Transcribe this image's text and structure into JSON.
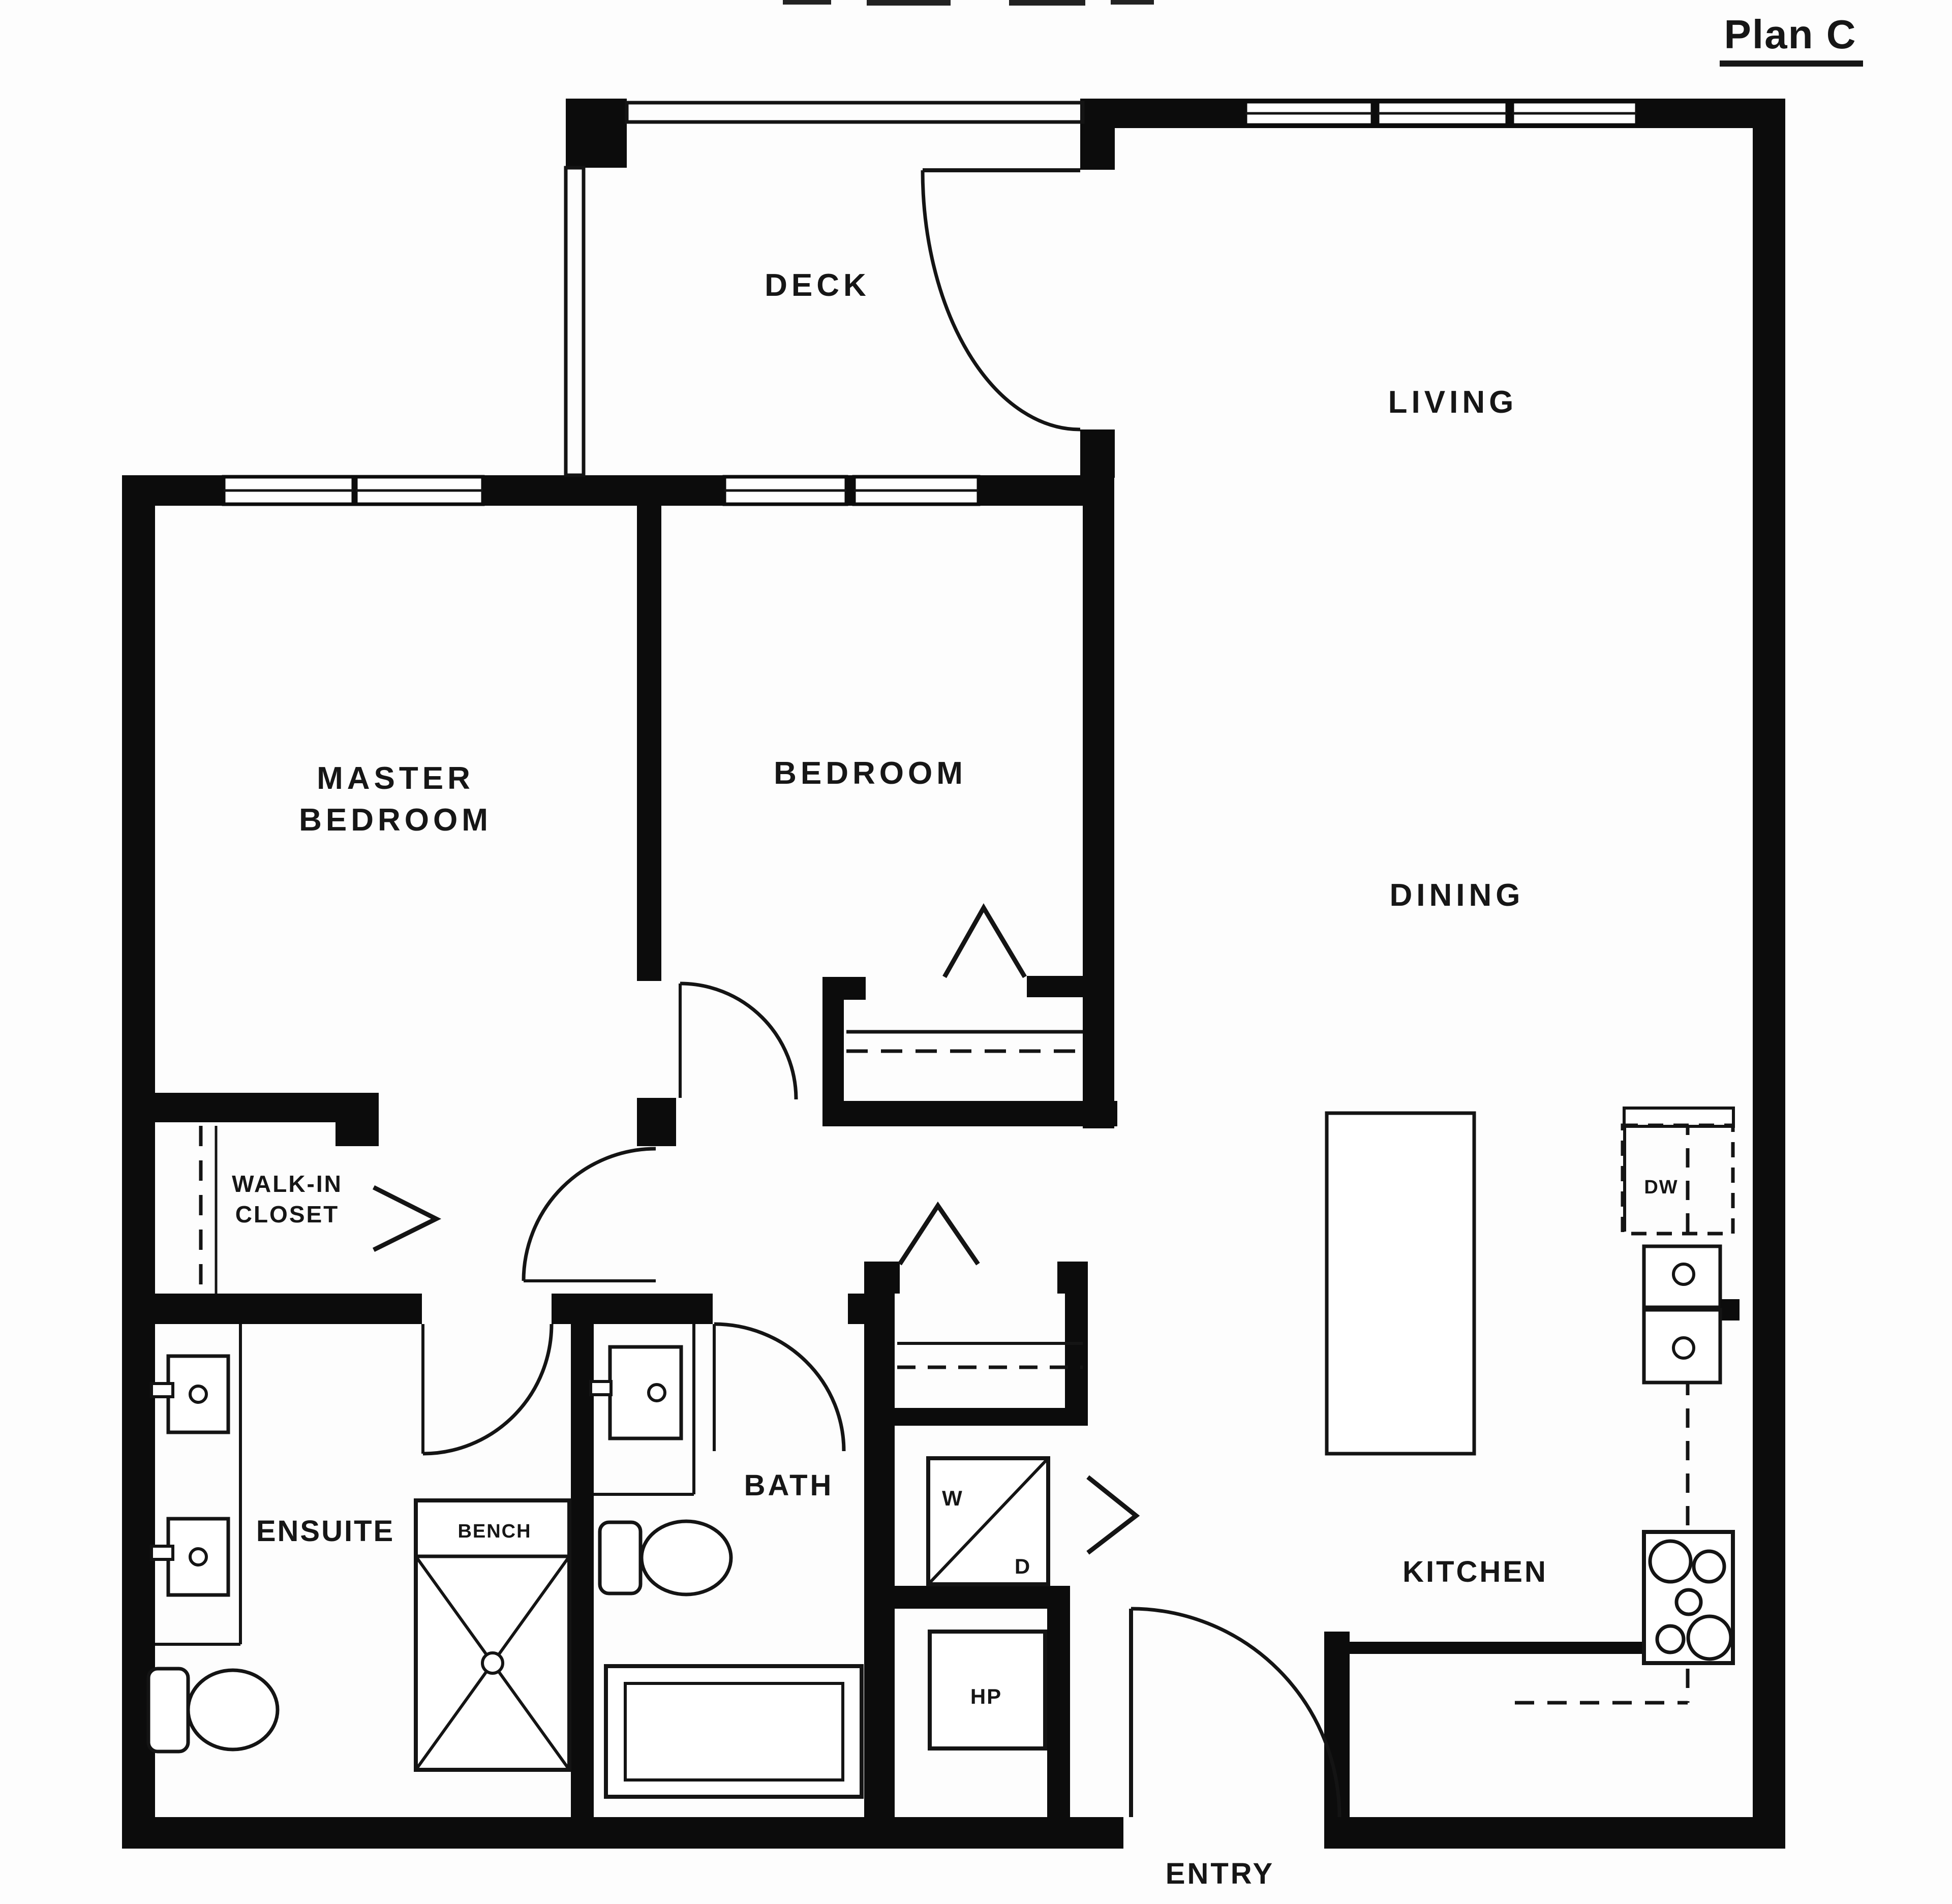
{
  "title": {
    "text": "Plan C"
  },
  "rooms": {
    "deck": "DECK",
    "living": "LIVING",
    "dining": "DINING",
    "master_bedroom_line1": "MASTER",
    "master_bedroom_line2": "BEDROOM",
    "bedroom": "BEDROOM",
    "walk_in_closet_line1": "WALK-IN",
    "walk_in_closet_line2": "CLOSET",
    "ensuite": "ENSUITE",
    "bath": "BATH",
    "kitchen": "KITCHEN",
    "entry": "ENTRY"
  },
  "fixtures": {
    "bench": "BENCH",
    "washer": "W",
    "dryer": "D",
    "heat_pump": "HP",
    "dishwasher": "DW"
  },
  "colors": {
    "wall": "#0c0c0c",
    "paper": "#fdfdfd",
    "ink": "#161616"
  }
}
